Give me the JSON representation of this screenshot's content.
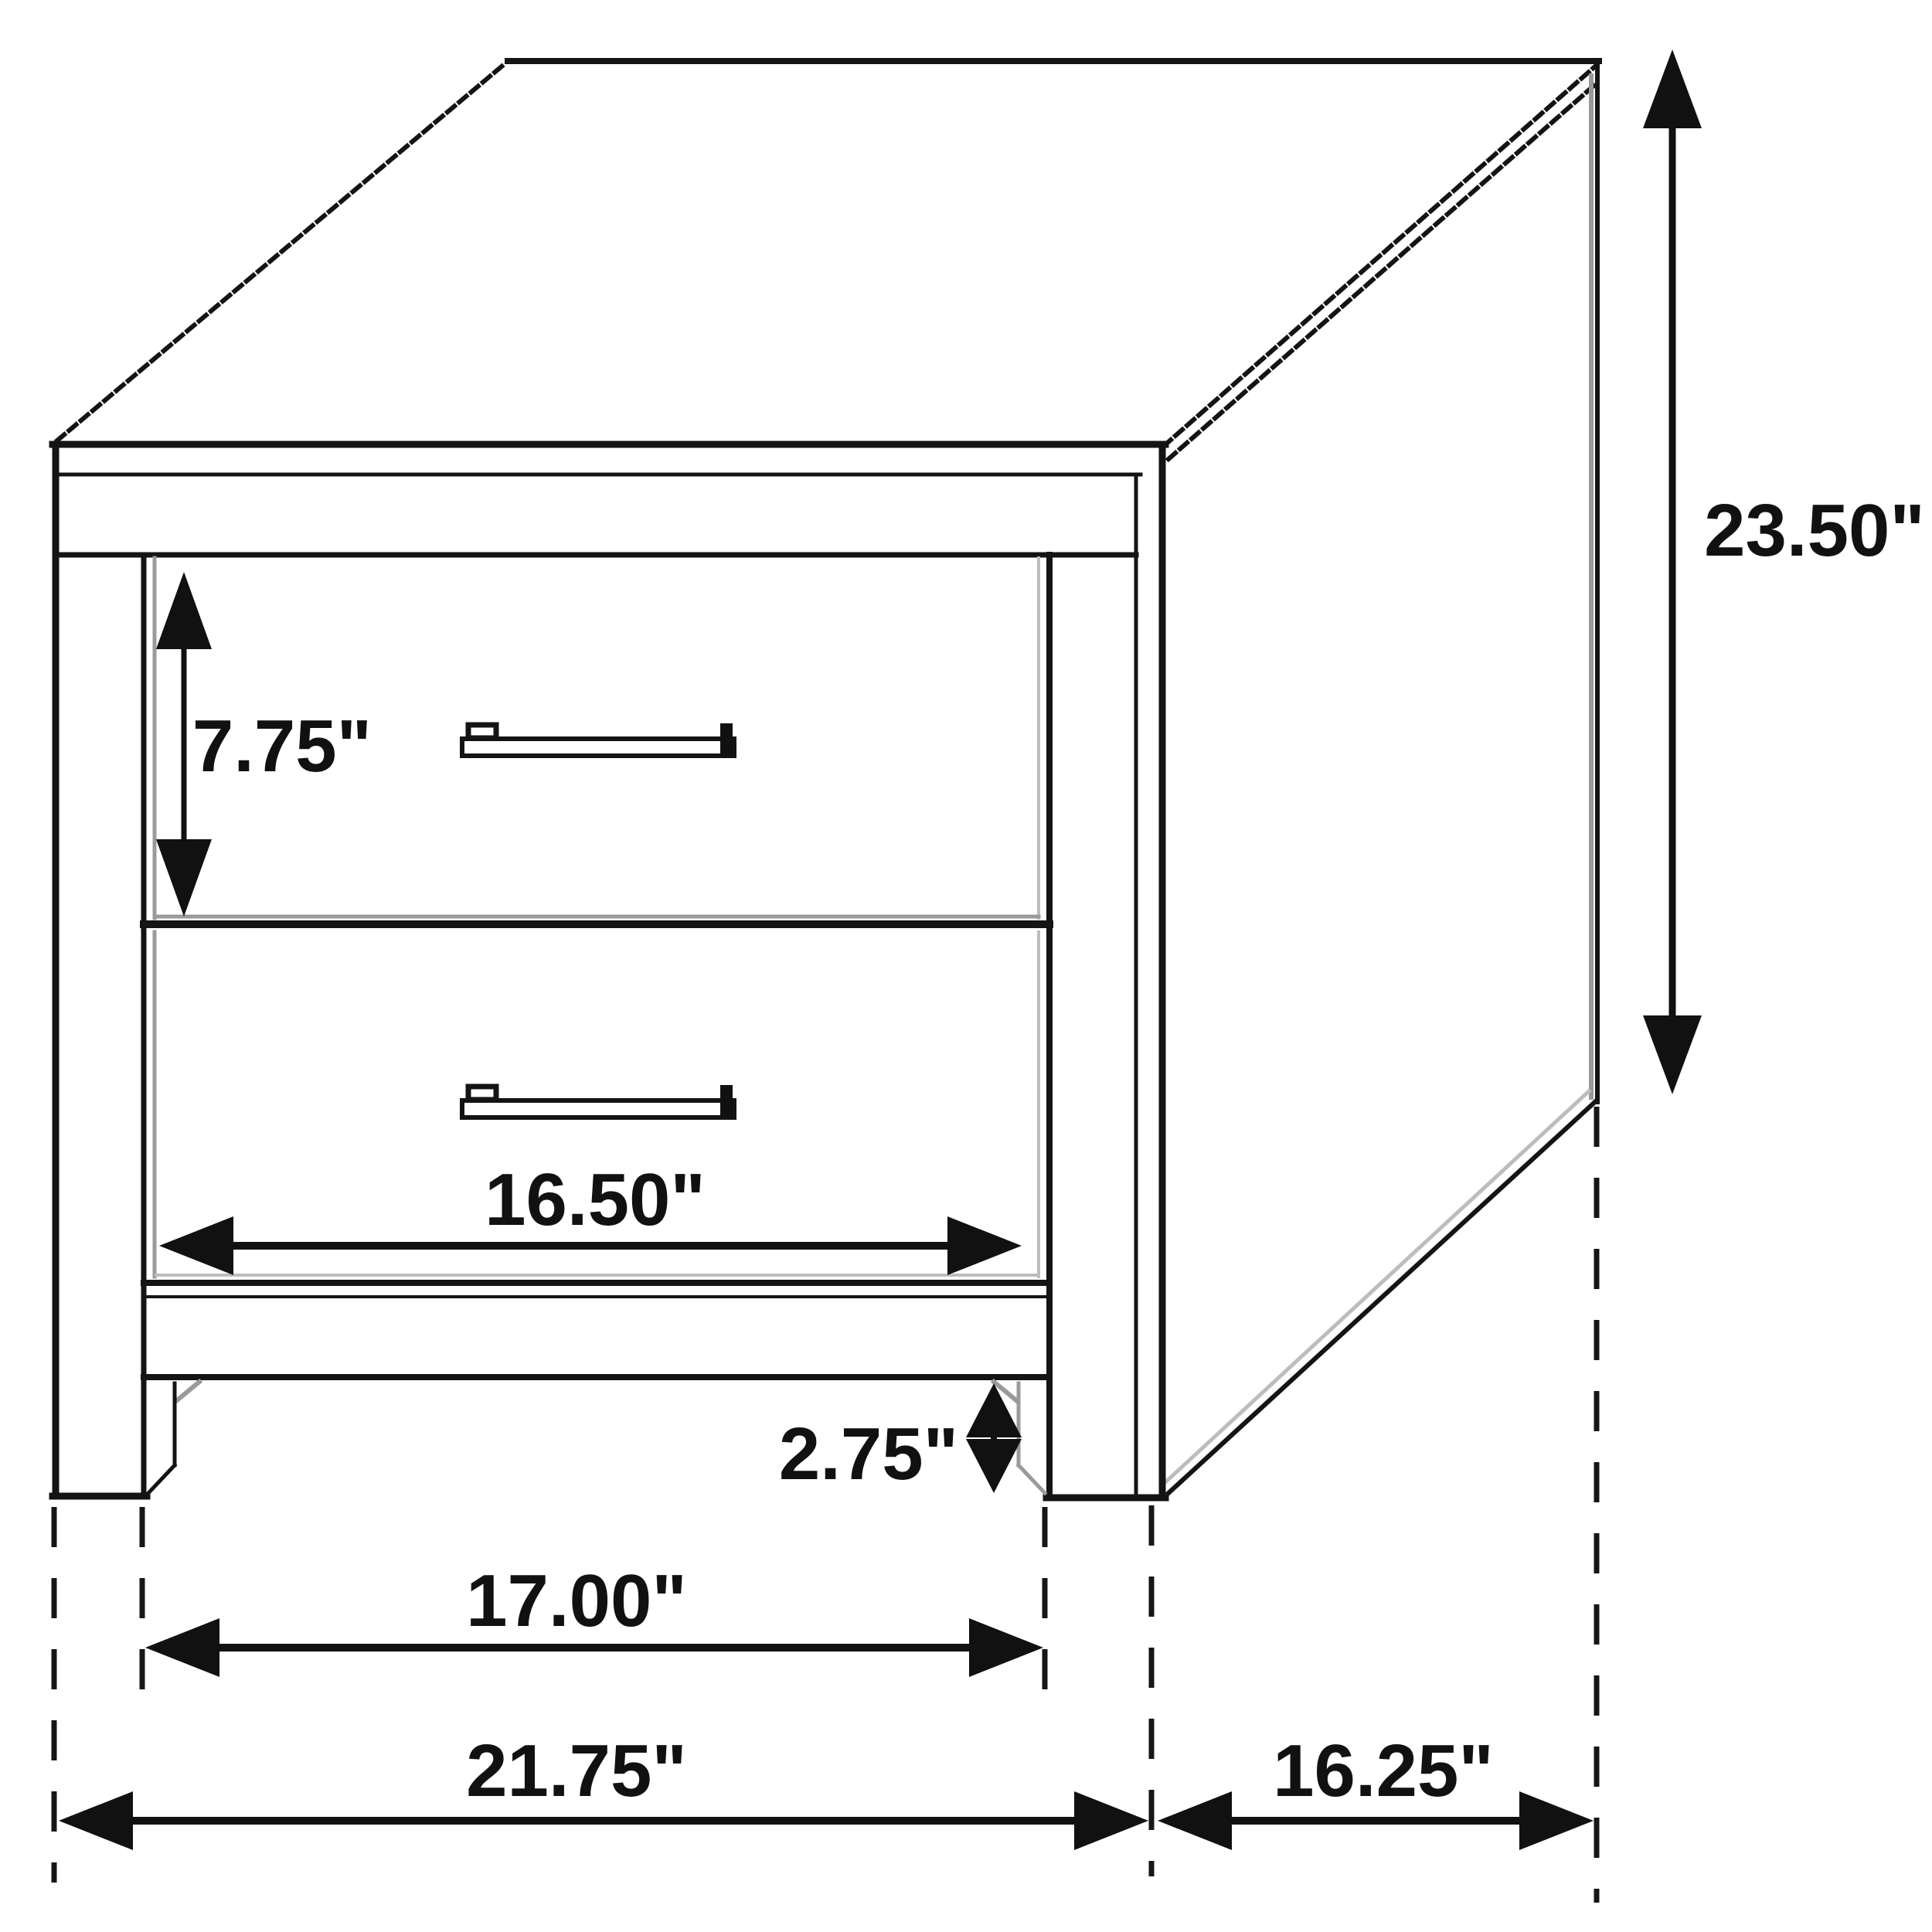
{
  "diagram": {
    "kind": "furniture-dimension-drawing",
    "subject": "two-drawer nightstand / end table, isometric line drawing",
    "units": "inches",
    "colors": {
      "background": "#ffffff",
      "line": "#141414",
      "shadow": "#9a9a9a",
      "text": "#111111"
    },
    "drawer_count": 2,
    "dimensions": {
      "overall_height": "23.50\"",
      "drawer_front_height": "7.75\"",
      "drawer_width": "16.50\"",
      "base_leg_height": "2.75\"",
      "inner_leg_span": "17.00\"",
      "overall_width": "21.75\"",
      "side_depth": "16.25\""
    }
  }
}
